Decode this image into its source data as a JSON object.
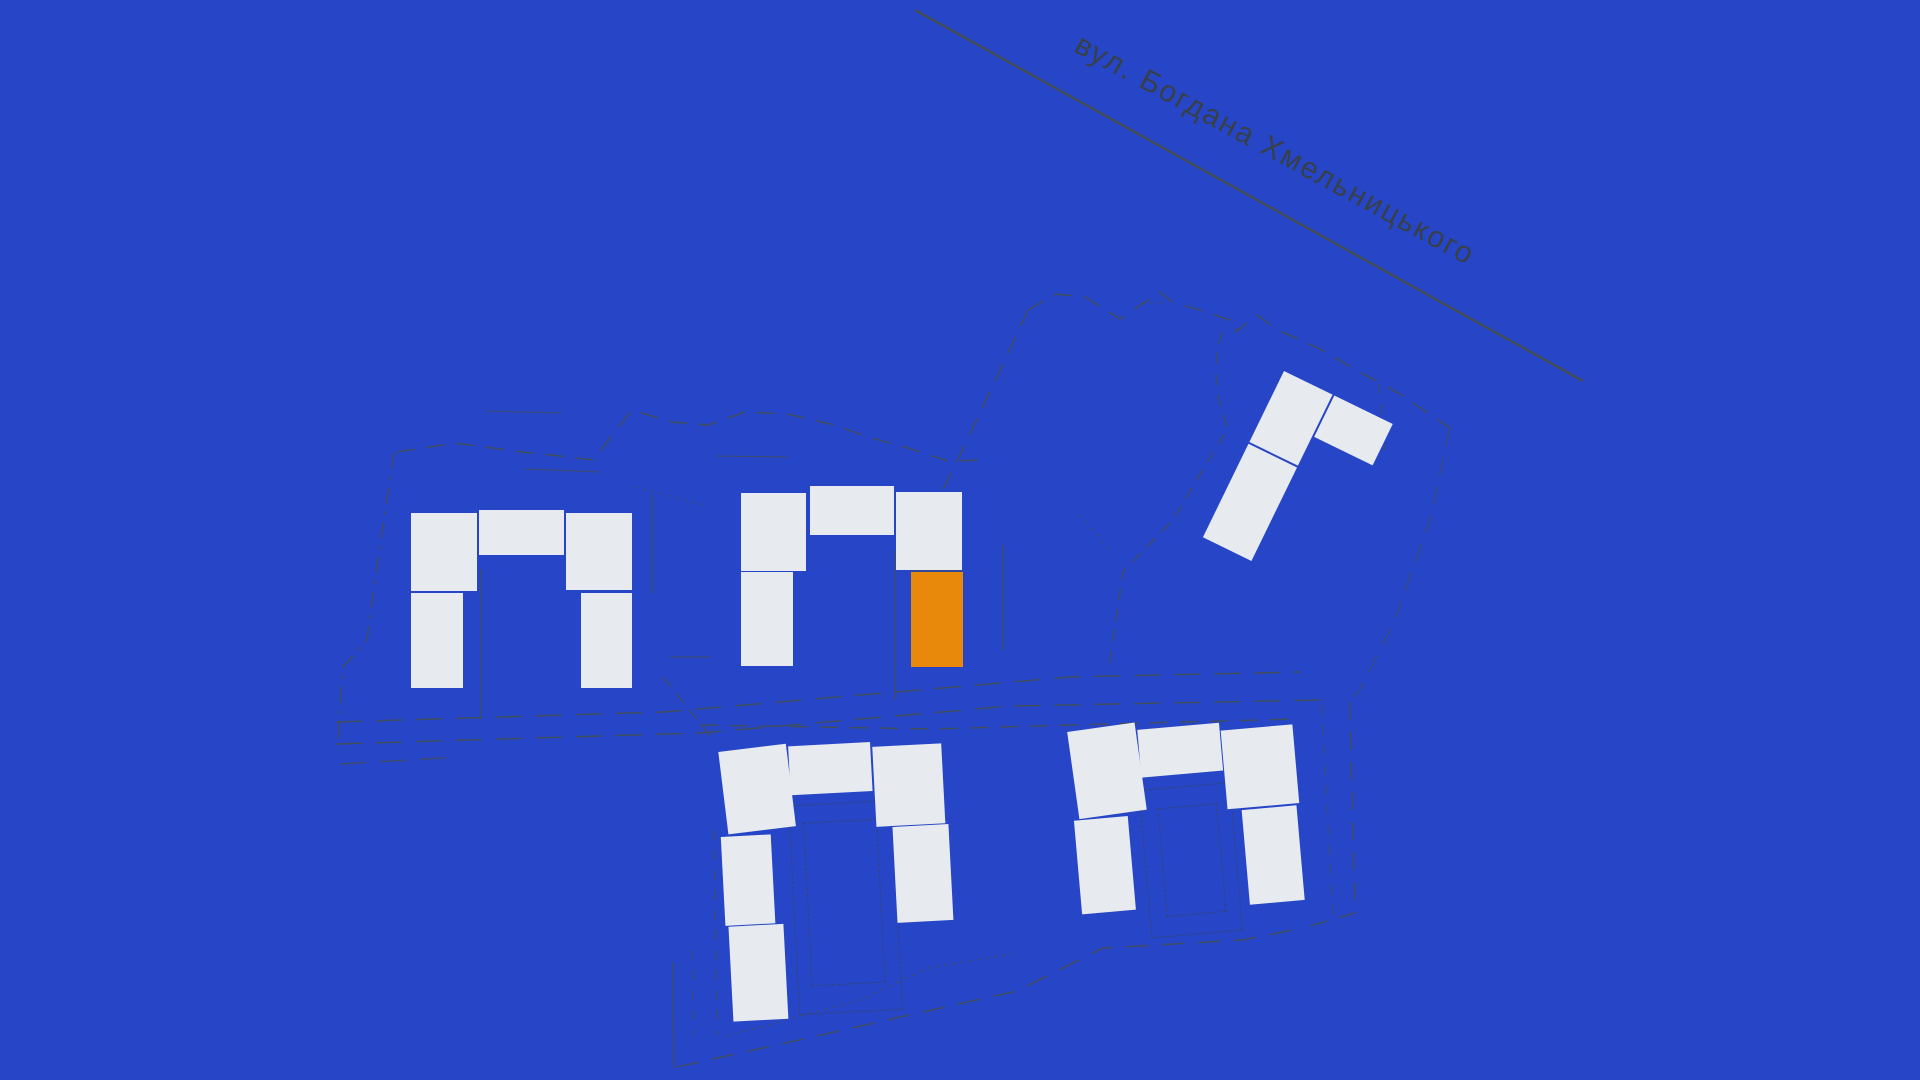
{
  "map": {
    "street": {
      "label": "вул. Богдана Хмельницького"
    },
    "colors": {
      "background": "#2646c7",
      "building": "#e7eaef",
      "highlight": "#e8890b",
      "linework": "#4a4f3e",
      "street_text": "#3b4032"
    },
    "building_groups": [
      {
        "id": "west-u-block",
        "origin": [
          0,
          0
        ],
        "rotate": 0,
        "sections": [
          {
            "x": 411,
            "y": 513,
            "w": 66,
            "h": 78
          },
          {
            "x": 479,
            "y": 510,
            "w": 85,
            "h": 45
          },
          {
            "x": 566,
            "y": 513,
            "w": 66,
            "h": 77
          },
          {
            "x": 411,
            "y": 593,
            "w": 52,
            "h": 95
          },
          {
            "x": 581,
            "y": 593,
            "w": 51,
            "h": 95
          }
        ]
      },
      {
        "id": "central-u-block",
        "origin": [
          0,
          0
        ],
        "rotate": 0,
        "sections": [
          {
            "x": 741,
            "y": 493,
            "w": 65,
            "h": 78
          },
          {
            "x": 810,
            "y": 486,
            "w": 84,
            "h": 49
          },
          {
            "x": 896,
            "y": 492,
            "w": 66,
            "h": 78
          },
          {
            "x": 741,
            "y": 572,
            "w": 52,
            "h": 94
          },
          {
            "x": 911,
            "y": 572,
            "w": 52,
            "h": 95,
            "highlight": true
          }
        ]
      },
      {
        "id": "northeast-l-block",
        "origin": [
          1284,
          371
        ],
        "rotate": 26,
        "sections": [
          {
            "x": 0,
            "y": 0,
            "w": 54,
            "h": 79
          },
          {
            "x": 0,
            "y": 81,
            "w": 54,
            "h": 104
          },
          {
            "x": 56,
            "y": 0,
            "w": 65,
            "h": 46
          }
        ]
      },
      {
        "id": "south-central-u-block",
        "origin": [
          718,
          746
        ],
        "rotate": -3,
        "sections": [
          {
            "x": 0,
            "y": 6,
            "w": 68,
            "h": 83,
            "tilt": -4
          },
          {
            "x": 70,
            "y": 4,
            "w": 82,
            "h": 49
          },
          {
            "x": 154,
            "y": 9,
            "w": 69,
            "h": 80
          },
          {
            "x": -2,
            "y": 91,
            "w": 50,
            "h": 89
          },
          {
            "x": 1,
            "y": 181,
            "w": 55,
            "h": 95
          },
          {
            "x": 170,
            "y": 90,
            "w": 56,
            "h": 96
          }
        ],
        "courtyard_outlines": [
          {
            "x": 67,
            "y": 63,
            "w": 102,
            "h": 208
          },
          {
            "x": 81,
            "y": 81,
            "w": 72,
            "h": 162
          }
        ]
      },
      {
        "id": "southeast-u-block",
        "origin": [
          1067,
          730
        ],
        "rotate": -5,
        "sections": [
          {
            "x": 0,
            "y": 2,
            "w": 68,
            "h": 88,
            "tilt": -3
          },
          {
            "x": 70,
            "y": 6,
            "w": 82,
            "h": 48
          },
          {
            "x": 153,
            "y": 14,
            "w": 72,
            "h": 79
          },
          {
            "x": -1,
            "y": 91,
            "w": 54,
            "h": 94
          },
          {
            "x": 167,
            "y": 95,
            "w": 55,
            "h": 95
          }
        ],
        "courtyard_outlines": [
          {
            "x": 66,
            "y": 66,
            "w": 90,
            "h": 147
          },
          {
            "x": 83,
            "y": 86,
            "w": 58,
            "h": 107
          }
        ]
      }
    ],
    "boundaries": [
      {
        "name": "street-line",
        "d": "M915,10 L1583,381",
        "w": 2.2,
        "opacity": 0.9
      },
      {
        "name": "cadastre-line",
        "d": "M481,569 L481,719",
        "w": 1.2,
        "opacity": 0.8
      },
      {
        "name": "cadastre-line",
        "d": "M652,495 L652,593",
        "w": 1.2,
        "opacity": 0.8
      },
      {
        "name": "cadastre-line",
        "d": "M895,551 L895,700",
        "w": 1.2,
        "opacity": 0.8
      },
      {
        "name": "cadastre-line",
        "d": "M1003,545 L1003,650",
        "w": 1.2,
        "opacity": 0.8
      },
      {
        "name": "cadastre-line",
        "d": "M673,962 L674,1068",
        "w": 1.2,
        "opacity": 0.8
      },
      {
        "name": "cadastre-line",
        "d": "M485,411 L562,413",
        "w": 1,
        "opacity": 0.6
      },
      {
        "name": "cadastre-line",
        "d": "M525,469 L600,472",
        "w": 1,
        "opacity": 0.7
      },
      {
        "name": "cadastre-line",
        "d": "M716,456 L787,457",
        "w": 1,
        "opacity": 0.7
      },
      {
        "name": "cadastre-line",
        "d": "M670,657 L710,657",
        "w": 1,
        "opacity": 0.7
      },
      {
        "name": "cadastre-line",
        "d": "M911,571 L963,571",
        "w": 1,
        "opacity": 0.7
      },
      {
        "name": "parcel-boundary",
        "d": "M397,452 L455,443 L522,452 L560,456 L593,460 L632,410 L672,422 L708,425 L745,412 L787,414 L835,425 L868,437 L908,448 L948,461 L985,460",
        "dash": "18 12",
        "opacity": 0.8
      },
      {
        "name": "parcel-boundary",
        "d": "M394,453 L375,580 L367,640 L343,667 L338,745",
        "dash": "16 8 3 8",
        "opacity": 0.8
      },
      {
        "name": "parcel-boundary",
        "d": "M1028,310 L997,377 L960,455 L928,520 L897,548",
        "dash": "18 12",
        "opacity": 0.8
      },
      {
        "name": "parcel-boundary",
        "d": "M1028,310 L1056,294 L1085,297 L1120,319 L1160,292 L1172,302 L1200,310 L1236,322 L1236,332 L1257,315 L1278,330 L1318,348 L1360,372 L1402,395 L1450,428",
        "dash": "18 12",
        "opacity": 0.8
      },
      {
        "name": "parcel-boundary",
        "d": "M1450,428 L1430,520 L1395,620 L1360,690 L1350,700",
        "dash": "18 12",
        "opacity": 0.55
      },
      {
        "name": "parcel-boundary",
        "d": "M1379,384 L1385,450",
        "dash": "10 10",
        "opacity": 0.55
      },
      {
        "name": "parcel-boundary",
        "d": "M1222,332 Q1208,380 1228,428 L1173,520 L1123,572 L1109,667",
        "dash": "12 9",
        "opacity": 0.7
      },
      {
        "name": "road-edge",
        "d": "M336,722 L663,712 L1070,677 L1300,672",
        "dash": "26 14",
        "opacity": 0.8
      },
      {
        "name": "road-edge",
        "d": "M336,744 L700,733 L1010,706 L1322,700",
        "dash": "26 14",
        "opacity": 0.8
      },
      {
        "name": "road-edge",
        "d": "M340,764 L460,757",
        "dash": "26 14",
        "opacity": 0.7
      },
      {
        "name": "parcel-boundary",
        "d": "M700,725 L933,729 L1143,723 L1298,719",
        "dash": "18 12",
        "opacity": 0.8
      },
      {
        "name": "parcel-boundary",
        "d": "M1350,702 L1355,913 L1303,928",
        "dash": "18 12",
        "opacity": 0.8
      },
      {
        "name": "parcel-boundary",
        "d": "M1322,705 L1333,918",
        "dash": "10 10",
        "opacity": 0.5
      },
      {
        "name": "parcel-boundary",
        "d": "M663,677 L712,738",
        "dash": "12 9",
        "opacity": 0.7
      },
      {
        "name": "parcel-boundary",
        "d": "M714,830 L717,1035",
        "dash": "10 10",
        "opacity": 0.6
      },
      {
        "name": "parcel-boundary",
        "d": "M692,950 L694,1035",
        "dash": "10 10",
        "opacity": 0.5
      },
      {
        "name": "parcel-boundary",
        "d": "M677,1067 L817,1036 L900,1017 L1017,991 L1103,948 L1242,940 L1303,928",
        "dash": "22 14",
        "opacity": 0.8
      },
      {
        "name": "survey-dots",
        "d": "M727,1036 L860,1000 L928,968 L1013,954",
        "dash": "2.5 6",
        "opacity": 0.7
      },
      {
        "name": "survey-dots",
        "d": "M635,487 L705,505",
        "dash": "2.5 6",
        "opacity": 0.6
      },
      {
        "name": "survey-dots",
        "d": "M1080,515 L1113,553",
        "dash": "2.5 6",
        "opacity": 0.6
      },
      {
        "name": "survey-dots",
        "d": "M1142,303 L1163,303",
        "dash": "2.5 6",
        "opacity": 0.6
      }
    ]
  }
}
